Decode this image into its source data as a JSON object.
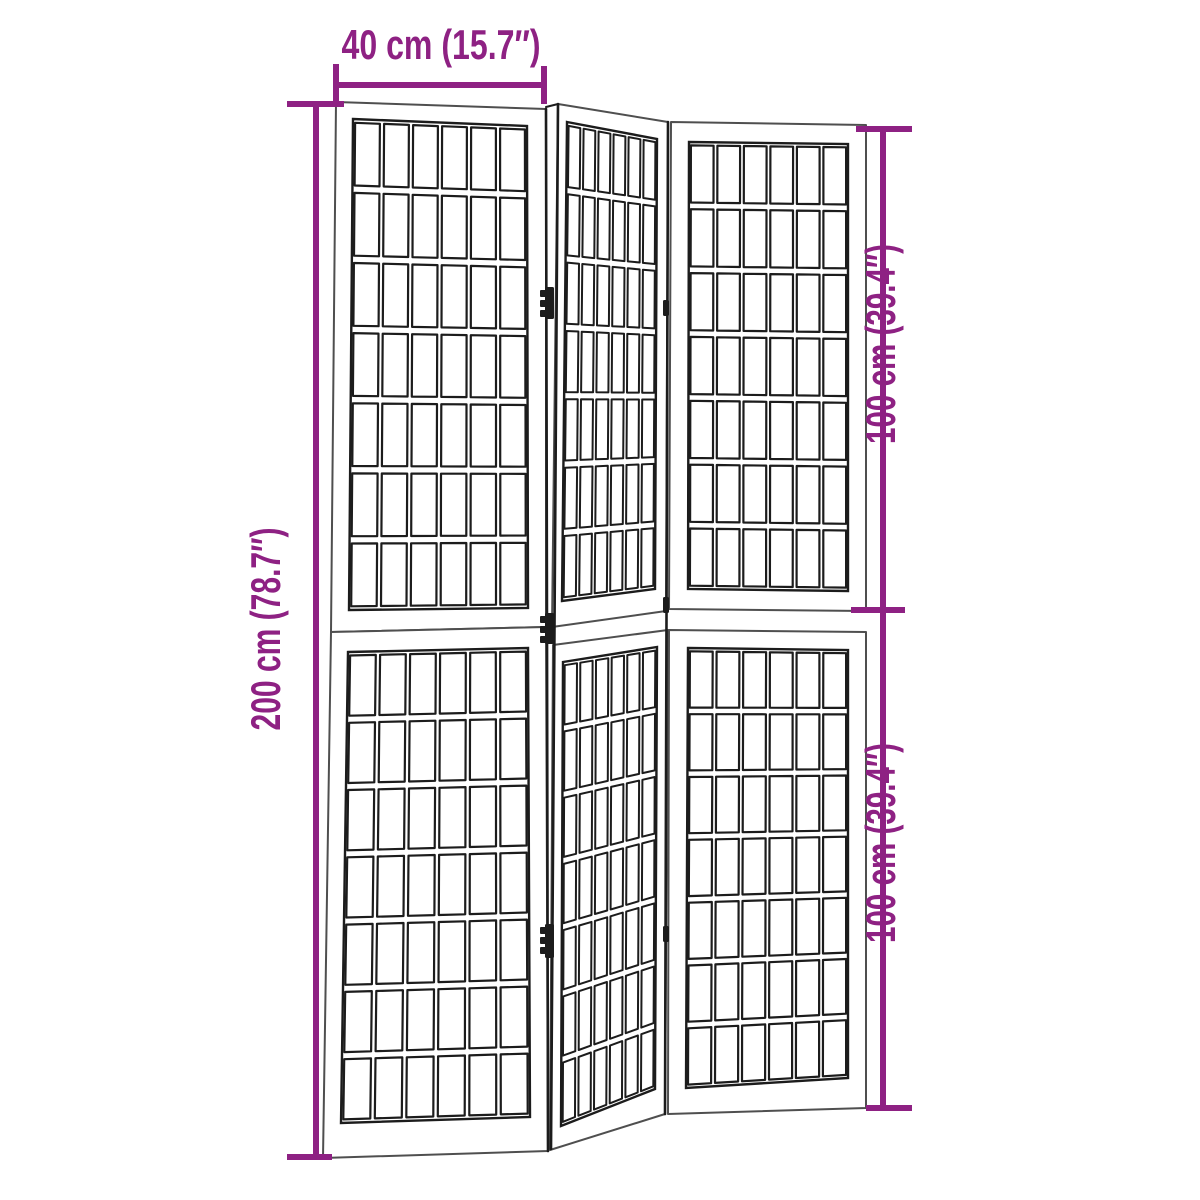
{
  "colors": {
    "background": "#ffffff",
    "ink": "#1c1c1c",
    "frame_outer": "#4f4f4f",
    "dimension": "#8e2183"
  },
  "dimension_labels": {
    "width": "40 cm (15.7″)",
    "height": "200 cm (78.7″)",
    "section_height_top": "100 cm (39.4″)",
    "section_height_bottom": "100 cm (39.4″)"
  },
  "drawing": {
    "canvas": {
      "width": 1200,
      "height": 1200
    },
    "panel_sections": [
      {
        "name": "left-upper",
        "outer": [
          [
            336,
            102
          ],
          [
            546,
            109
          ],
          [
            546,
            627
          ],
          [
            331,
            632
          ]
        ],
        "inner": [
          [
            353,
            119
          ],
          [
            527,
            126
          ],
          [
            528,
            608
          ],
          [
            349,
            610
          ]
        ],
        "cols": 6,
        "rows": 7,
        "mu": 0.012,
        "mv": 0.0075,
        "cell_stroke": 2.2
      },
      {
        "name": "left-lower",
        "outer": [
          [
            331,
            632
          ],
          [
            546,
            627
          ],
          [
            548,
            1151
          ],
          [
            323,
            1158
          ]
        ],
        "inner": [
          [
            348,
            652
          ],
          [
            528,
            648
          ],
          [
            530,
            1117
          ],
          [
            341,
            1123
          ]
        ],
        "cols": 6,
        "rows": 7,
        "mu": 0.012,
        "mv": 0.0075,
        "cell_stroke": 2.2
      },
      {
        "name": "middle-upper",
        "outer": [
          [
            558,
            104
          ],
          [
            668,
            122
          ],
          [
            666,
            611
          ],
          [
            552,
            627
          ]
        ],
        "inner": [
          [
            567,
            122
          ],
          [
            657,
            139
          ],
          [
            655,
            589
          ],
          [
            562,
            601
          ]
        ],
        "cols": 6,
        "rows": 7,
        "mu": 0.018,
        "mv": 0.0075,
        "cell_stroke": 2.0
      },
      {
        "name": "middle-lower",
        "outer": [
          [
            553,
            645
          ],
          [
            668,
            630
          ],
          [
            665,
            1114
          ],
          [
            550,
            1150
          ]
        ],
        "inner": [
          [
            563,
            662
          ],
          [
            657,
            647
          ],
          [
            655,
            1089
          ],
          [
            561,
            1126
          ]
        ],
        "cols": 6,
        "rows": 7,
        "mu": 0.018,
        "mv": 0.0075,
        "cell_stroke": 2.0
      },
      {
        "name": "right-upper",
        "outer": [
          [
            671,
            122
          ],
          [
            866,
            125
          ],
          [
            866,
            611
          ],
          [
            669,
            609
          ]
        ],
        "inner": [
          [
            689,
            142
          ],
          [
            848,
            144
          ],
          [
            848,
            591
          ],
          [
            688,
            589
          ]
        ],
        "cols": 6,
        "rows": 7,
        "mu": 0.012,
        "mv": 0.0075,
        "cell_stroke": 2.2
      },
      {
        "name": "right-lower",
        "outer": [
          [
            669,
            630
          ],
          [
            866,
            632
          ],
          [
            866,
            1108
          ],
          [
            668,
            1114
          ]
        ],
        "inner": [
          [
            688,
            648
          ],
          [
            848,
            650
          ],
          [
            848,
            1078
          ],
          [
            686,
            1088
          ]
        ],
        "cols": 6,
        "rows": 7,
        "mu": 0.012,
        "mv": 0.0075,
        "cell_stroke": 2.2
      }
    ],
    "junction_lines": [
      {
        "name": "left-panel-right-edge",
        "points": [
          [
            546,
            109
          ],
          [
            548,
            1151
          ]
        ],
        "width": 2.6
      },
      {
        "name": "middle-panel-left-edge",
        "points": [
          [
            558,
            104
          ],
          [
            551,
            1149
          ]
        ],
        "width": 2.6
      },
      {
        "name": "middle-panel-right-edge",
        "points": [
          [
            668,
            122
          ],
          [
            665,
            1114
          ]
        ],
        "width": 2.6
      },
      {
        "name": "top-hinge-connector",
        "points": [
          [
            546,
            107
          ],
          [
            558,
            104
          ]
        ],
        "width": 2.0
      }
    ],
    "hinges": [
      {
        "name": "hinge-left-top",
        "x": 545,
        "y": 287,
        "w": 9,
        "h": 32,
        "knuckles": true
      },
      {
        "name": "hinge-left-middle",
        "x": 545,
        "y": 613,
        "w": 9,
        "h": 31,
        "knuckles": true
      },
      {
        "name": "hinge-left-bottom",
        "x": 545,
        "y": 924,
        "w": 9,
        "h": 34,
        "knuckles": true
      },
      {
        "name": "hinge-right-top",
        "x": 663,
        "y": 300,
        "w": 6,
        "h": 16,
        "knuckles": false
      },
      {
        "name": "hinge-right-middle",
        "x": 663,
        "y": 597,
        "w": 6,
        "h": 16,
        "knuckles": false
      },
      {
        "name": "hinge-right-bottom",
        "x": 663,
        "y": 926,
        "w": 6,
        "h": 16,
        "knuckles": false
      }
    ],
    "dimension_lines": [
      {
        "name": "width-dimension-line",
        "main": [
          [
            336,
            85
          ],
          [
            544,
            85
          ]
        ],
        "ticks": [
          [
            [
              336,
              64
            ],
            [
              336,
              106
            ]
          ],
          [
            [
              544,
              66
            ],
            [
              544,
              104
            ]
          ]
        ],
        "width": 6
      },
      {
        "name": "height-dimension-line",
        "main": [
          [
            316,
            104
          ],
          [
            316,
            1157
          ]
        ],
        "ticks": [
          [
            [
              287,
              104
            ],
            [
              344,
              104
            ]
          ],
          [
            [
              287,
              1157
            ],
            [
              332,
              1157
            ]
          ]
        ],
        "width": 6
      },
      {
        "name": "section-dimension-line",
        "main": [
          [
            883,
            129
          ],
          [
            883,
            1108
          ]
        ],
        "ticks": [
          [
            [
              856,
              129
            ],
            [
              912,
              129
            ]
          ],
          [
            [
              851,
              610
            ],
            [
              905,
              610
            ]
          ],
          [
            [
              866,
              1108
            ],
            [
              912,
              1108
            ]
          ]
        ],
        "width": 6
      }
    ],
    "labels": [
      {
        "name": "width-dimension-label",
        "key": "width",
        "x": 441,
        "y": 59,
        "rotate": 0,
        "length": 199
      },
      {
        "name": "height-dimension-label",
        "key": "height",
        "x": 280,
        "y": 629,
        "rotate": -90,
        "length": 203
      },
      {
        "name": "upper-section-dimension-label",
        "key": "section_height_top",
        "x": 895,
        "y": 344,
        "rotate": -90,
        "length": 200
      },
      {
        "name": "lower-section-dimension-label",
        "key": "section_height_bottom",
        "x": 895,
        "y": 843,
        "rotate": -90,
        "length": 200
      }
    ]
  }
}
